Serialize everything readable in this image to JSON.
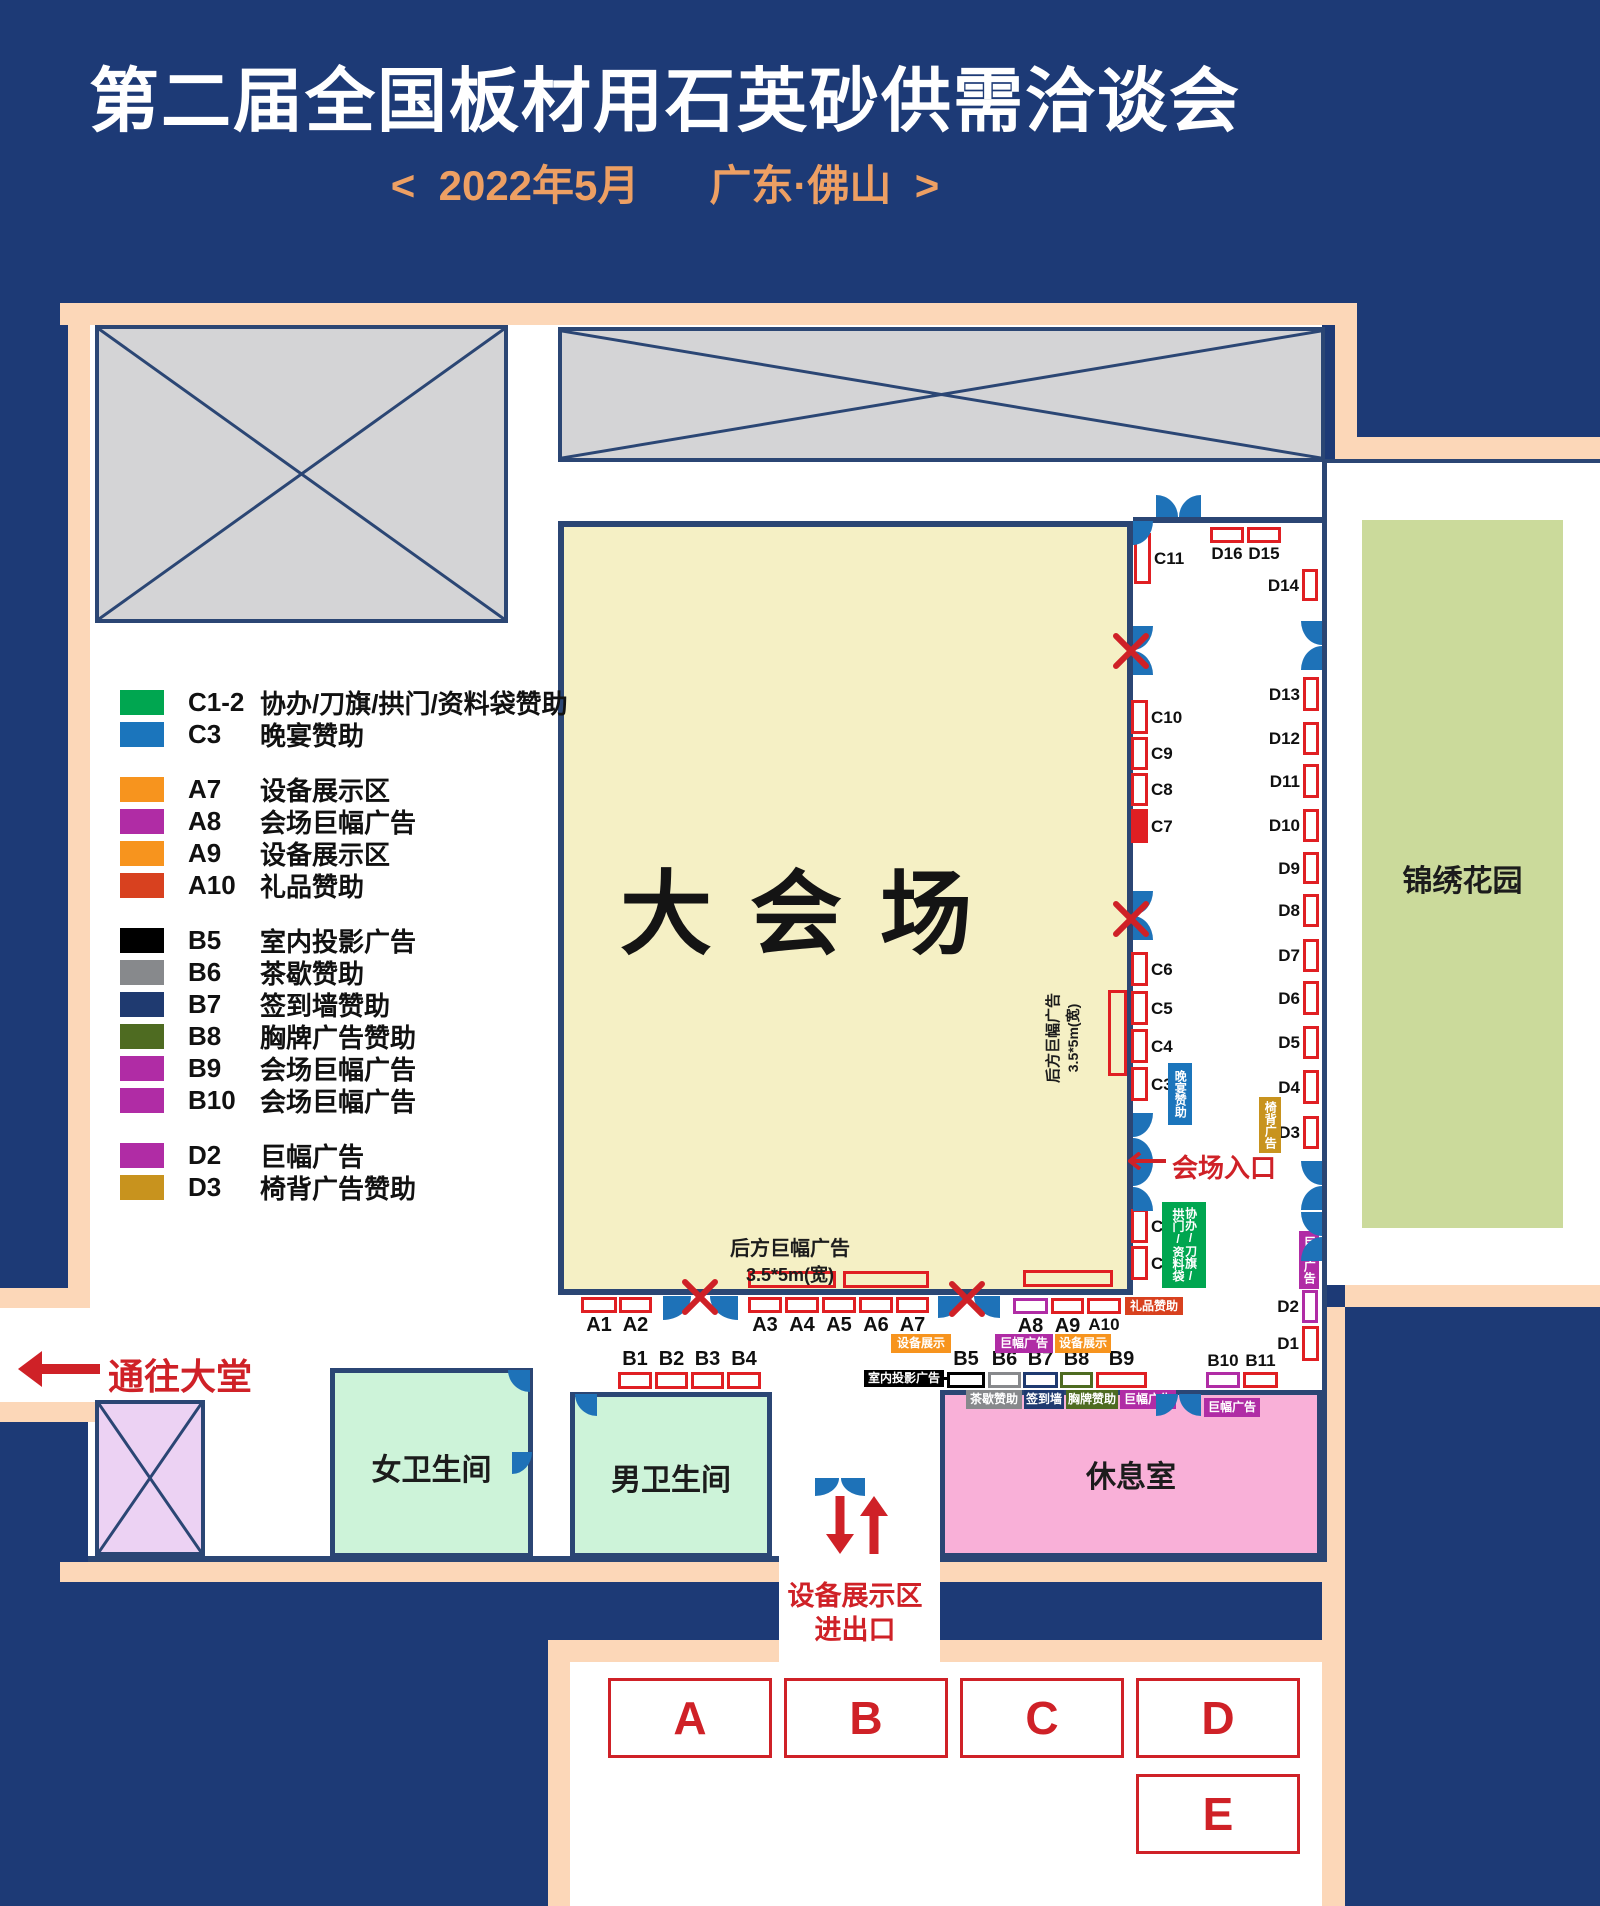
{
  "title": "第二届全国板材用石英砂供需洽谈会",
  "subtitle": "<  2022年5月      广东·佛山  >",
  "palette": {
    "page_bg": "#1d3a76",
    "border_peach": "#fcd7b8",
    "wall": "#2b4674",
    "blocked_gray": "#d4d4d6",
    "blocked_purple": "#ecd2f3",
    "hall_fill": "#f5f0c5",
    "garden_green": "#cbda9b",
    "restroom_mint": "#cdf3d9",
    "lounge_pink": "#f9b0d8",
    "booth_red": "#e01f23",
    "accent_red": "#cf2127",
    "door_blue": "#1e72b8",
    "green": "#00a650",
    "blue": "#1b75bc",
    "orange": "#f7941e",
    "magenta": "#b02ca5",
    "vermilion": "#d8411f",
    "black": "#000000",
    "gray": "#87898c",
    "navy": "#1f3a70",
    "olive": "#4e6b21",
    "gold": "#c8931e",
    "subtitle_orange": "#ed9f63"
  },
  "legend": {
    "groups": [
      [
        {
          "code": "C1-2",
          "label": "协办/刀旗/拱门/资料袋赞助",
          "color": "green"
        },
        {
          "code": "C3",
          "label": "晚宴赞助",
          "color": "blue"
        }
      ],
      [
        {
          "code": "A7",
          "label": "设备展示区",
          "color": "orange"
        },
        {
          "code": "A8",
          "label": "会场巨幅广告",
          "color": "magenta"
        },
        {
          "code": "A9",
          "label": "设备展示区",
          "color": "orange"
        },
        {
          "code": "A10",
          "label": "礼品赞助",
          "color": "vermilion"
        }
      ],
      [
        {
          "code": "B5",
          "label": "室内投影广告",
          "color": "black"
        },
        {
          "code": "B6",
          "label": "茶歇赞助",
          "color": "gray"
        },
        {
          "code": "B7",
          "label": "签到墙赞助",
          "color": "navy"
        },
        {
          "code": "B8",
          "label": "胸牌广告赞助",
          "color": "olive"
        },
        {
          "code": "B9",
          "label": "会场巨幅广告",
          "color": "magenta"
        },
        {
          "code": "B10",
          "label": "会场巨幅广告",
          "color": "magenta"
        }
      ],
      [
        {
          "code": "D2",
          "label": "巨幅广告",
          "color": "magenta"
        },
        {
          "code": "D3",
          "label": "椅背广告赞助",
          "color": "gold"
        }
      ]
    ]
  },
  "rooms": {
    "main_hall": "大会场",
    "garden": "锦绣花园",
    "women_restroom": "女卫生间",
    "men_restroom": "男卫生间",
    "lounge": "休息室"
  },
  "booths": {
    "a_row": [
      "A1",
      "A2",
      "A3",
      "A4",
      "A5",
      "A6",
      "A7",
      "A8",
      "A9",
      "A10"
    ],
    "b_row": [
      "B1",
      "B2",
      "B3",
      "B4",
      "B5",
      "B6",
      "B7",
      "B8",
      "B9",
      "B10",
      "B11"
    ],
    "c_col": [
      "C1",
      "C2",
      "C3",
      "C4",
      "C5",
      "C6",
      "C7",
      "C8",
      "C9",
      "C10",
      "C11"
    ],
    "d_col": [
      "D1",
      "D2",
      "D3",
      "D4",
      "D5",
      "D6",
      "D7",
      "D8",
      "D9",
      "D10",
      "D11",
      "D12",
      "D13",
      "D14",
      "D15",
      "D16"
    ],
    "zones": [
      "A",
      "B",
      "C",
      "D",
      "E"
    ]
  },
  "tags": {
    "dinner": "晚宴赞助",
    "coop": "协办/刀旗/拱门/资料袋",
    "chair": "椅背广告",
    "banner": "巨幅广告",
    "equip": "设备展示",
    "gift": "礼品赞助",
    "projection": "室内投影广告",
    "tea": "茶歇赞助",
    "signwall": "签到墙",
    "badge": "胸牌赞助"
  },
  "annotations": {
    "entrance": "会场入口",
    "to_lobby": "通往大堂",
    "equip_gate_line1": "设备展示区",
    "equip_gate_line2": "进出口",
    "rear_banner_line1": "后方巨幅广告",
    "rear_banner_line2": "3.5*5m(宽)"
  }
}
